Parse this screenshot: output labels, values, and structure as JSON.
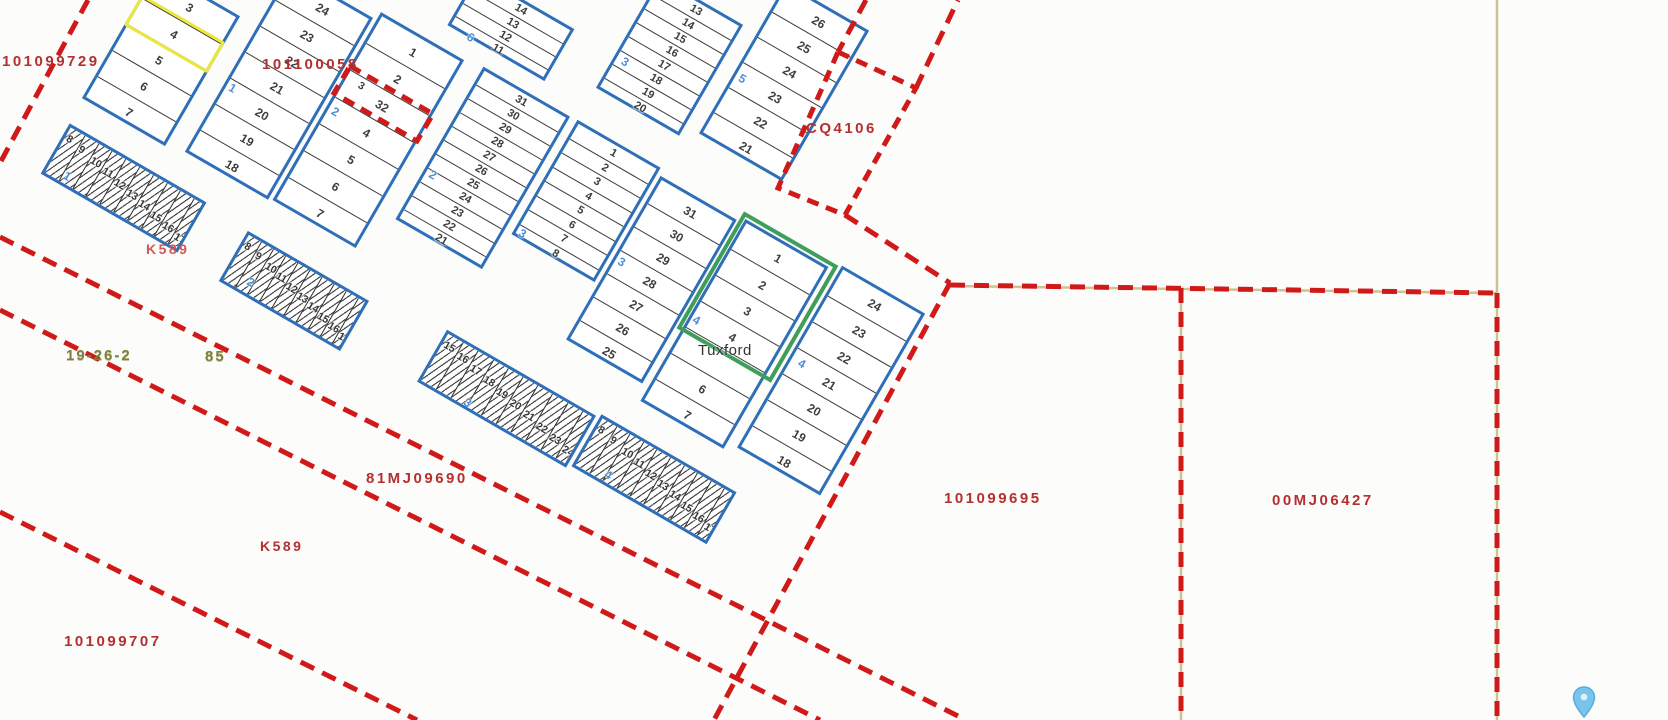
{
  "map": {
    "background": "#fcfcfa",
    "colors": {
      "block_border": "#2f6fb8",
      "lot_number": "#3d3d3d",
      "block_number_blue": "#4d8fd6",
      "boundary_red": "#d01a1a",
      "survey_tan": "#cbc296",
      "highlight_yellow": "#ece73c",
      "highlight_green": "#3f9e5a",
      "parcel_id_red": "#b43030",
      "section_olive": "#80803a",
      "pin_blue": "#7ac4ea"
    },
    "town_label": {
      "text": "Tuxford",
      "x": 698,
      "y": 343
    },
    "parcel_id_labels": [
      {
        "text": "101099729",
        "x": 2,
        "y": 54,
        "color": "#b43030",
        "size": 15
      },
      {
        "text": "101100058",
        "x": 262,
        "y": 57,
        "color": "#b43030",
        "size": 15
      },
      {
        "text": "CQ4106",
        "x": 806,
        "y": 121,
        "color": "#b43030",
        "size": 15
      },
      {
        "text": "K589",
        "x": 146,
        "y": 242,
        "color": "#d05858",
        "size": 14
      },
      {
        "text": "81MJ09690",
        "x": 366,
        "y": 471,
        "color": "#b43030",
        "size": 15
      },
      {
        "text": "K589",
        "x": 260,
        "y": 539,
        "color": "#b43030",
        "size": 14
      },
      {
        "text": "101099707",
        "x": 64,
        "y": 634,
        "color": "#b43030",
        "size": 15
      },
      {
        "text": "101099695",
        "x": 944,
        "y": 491,
        "color": "#b43030",
        "size": 15
      },
      {
        "text": "00MJ06427",
        "x": 1272,
        "y": 493,
        "color": "#b43030",
        "size": 15
      }
    ],
    "section_labels": [
      {
        "text": "19-26-2",
        "x": 66,
        "y": 348
      },
      {
        "text": "85",
        "x": 205,
        "y": 349
      }
    ],
    "grid_rotation_deg": 30,
    "blocks": [
      {
        "id": "A",
        "u": 120,
        "v": -106,
        "w": 96,
        "lotH": 30,
        "lots": [
          "3",
          "4",
          "5",
          "6",
          "7"
        ],
        "yellow_lot_index": 1
      },
      {
        "id": "B",
        "u": 236,
        "v": -171,
        "w": 96,
        "lotH": 30,
        "lots": [
          "24",
          "23",
          "22",
          "21",
          "20",
          "19",
          "18"
        ],
        "blue": {
          "t": "1",
          "du": 3,
          "dv": 122
        }
      },
      {
        "id": "C",
        "u": 336,
        "v": -180,
        "w": 96,
        "lotH": 31,
        "lots": [
          "1",
          "2",
          "32",
          "4",
          "5",
          "6",
          "7"
        ],
        "blue": {
          "t": "2",
          "du": 4,
          "dv": 100
        },
        "smalls": [
          {
            "t": "3",
            "du": 14,
            "dv": 66,
            "c": "#3d3d3d"
          }
        ]
      },
      {
        "id": "E",
        "u": 452,
        "v": -184,
        "w": 100,
        "lotH": 16,
        "lots": [
          "31",
          "30",
          "29",
          "28",
          "27",
          "26",
          "25",
          "24",
          "23",
          "22",
          "21"
        ],
        "blue": {
          "t": "2",
          "du": 4,
          "dv": 110
        }
      },
      {
        "id": "F",
        "u": 560,
        "v": -185,
        "w": 96,
        "lotH": 16.5,
        "lots": [
          "1",
          "2",
          "3",
          "4",
          "5",
          "6",
          "7",
          "8"
        ],
        "blue": {
          "t": "3",
          "du": 3,
          "dv": 117
        }
      },
      {
        "id": "G",
        "u": 660,
        "v": -178,
        "w": 88,
        "lotH": 27,
        "lots": [
          "31",
          "30",
          "29",
          "28",
          "27",
          "26",
          "25"
        ],
        "blue": {
          "t": "3",
          "du": 3,
          "dv": 85
        }
      },
      {
        "id": "H",
        "u": 560,
        "v": -350,
        "w": 96,
        "lotH": 16,
        "lots": [
          "13",
          "14",
          "15",
          "16",
          "17",
          "18",
          "19",
          "20"
        ],
        "blue": {
          "t": "3",
          "du": 6,
          "dv": 82
        }
      },
      {
        "id": "I",
        "u": 672,
        "v": -408,
        "w": 96,
        "lotH": 29,
        "lots": [
          "26",
          "25",
          "24",
          "23",
          "22",
          "21"
        ],
        "blue": {
          "t": "5",
          "du": 4,
          "dv": 96
        }
      },
      {
        "id": "P",
        "u": 400,
        "v": -262,
        "w": 112,
        "lotH": 15,
        "lots": [
          "14",
          "13",
          "12",
          "11"
        ],
        "blue": {
          "t": "6",
          "du": 20,
          "dv": 50
        }
      },
      {
        "id": "K",
        "u": 755,
        "v": -183,
        "w": 96,
        "lotH": 30,
        "lots": [
          "1",
          "2",
          "3",
          "4",
          "",
          "6",
          "7"
        ],
        "blue": {
          "t": "4",
          "du": 2,
          "dv": 103
        },
        "green": {
          "from": 0,
          "to": 3
        }
      },
      {
        "id": "L",
        "u": 862,
        "v": -191,
        "w": 96,
        "lotH": 30,
        "lots": [
          "24",
          "23",
          "22",
          "21",
          "20",
          "19",
          "18"
        ],
        "blue": {
          "t": "4",
          "du": 8,
          "dv": 96
        }
      }
    ],
    "hatch_blocks": [
      {
        "id": "hA",
        "u": 122,
        "v": 72,
        "w": 158,
        "h": 58,
        "lots": [
          "8",
          "9",
          "10",
          "11",
          "12",
          "13",
          "14",
          "15",
          "16",
          "17"
        ],
        "blue": {
          "t": "1",
          "du": 18,
          "dv": 38
        }
      },
      {
        "id": "hB",
        "u": 330,
        "v": 76,
        "w": 140,
        "h": 58,
        "lots": [
          "8",
          "9",
          "10",
          "11",
          "12",
          "13",
          "14",
          "15",
          "16",
          "17"
        ],
        "blue": {
          "t": "2",
          "du": 22,
          "dv": 34
        }
      },
      {
        "id": "hD",
        "u": 552,
        "v": 62,
        "w": 172,
        "h": 60,
        "lots": [
          "15",
          "16",
          "17",
          "18",
          "19",
          "20",
          "21",
          "22",
          "23",
          "24"
        ],
        "blue": {
          "t": "3",
          "du": 48,
          "dv": 44
        }
      },
      {
        "id": "hM",
        "u": 728,
        "v": 58,
        "w": 156,
        "h": 60,
        "lots": [
          "8",
          "9",
          "10",
          "11",
          "12",
          "13",
          "14",
          "15",
          "16",
          "17"
        ],
        "blue": {
          "t": "4",
          "du": 30,
          "dv": 40
        }
      }
    ],
    "survey_tan_lines": [
      [
        1497,
        0,
        1497,
        720
      ],
      [
        950,
        286,
        1497,
        293
      ],
      [
        1181,
        289,
        1181,
        720
      ]
    ],
    "boundary_red_dashed_lines": [
      [
        88,
        0,
        0,
        163
      ],
      [
        0,
        237,
        966,
        720
      ],
      [
        950,
        283,
        714,
        720
      ],
      [
        950,
        285,
        1497,
        293
      ],
      [
        1497,
        293,
        1497,
        720
      ],
      [
        1181,
        288,
        1181,
        720
      ],
      [
        0,
        310,
        820,
        720
      ],
      [
        0,
        512,
        417,
        720
      ],
      [
        845,
        215,
        950,
        283
      ],
      [
        866,
        0,
        838,
        52
      ],
      [
        916,
        88,
        958,
        0
      ]
    ],
    "boundary_red_dashed_polygons": [
      [
        [
          838,
          52
        ],
        [
          916,
          88
        ],
        [
          845,
          215
        ],
        [
          778,
          188
        ]
      ],
      [
        [
          350,
          66
        ],
        [
          433,
          114
        ],
        [
          417,
          141
        ],
        [
          334,
          93
        ]
      ]
    ],
    "pin": {
      "x": 1572,
      "y": 686
    }
  }
}
